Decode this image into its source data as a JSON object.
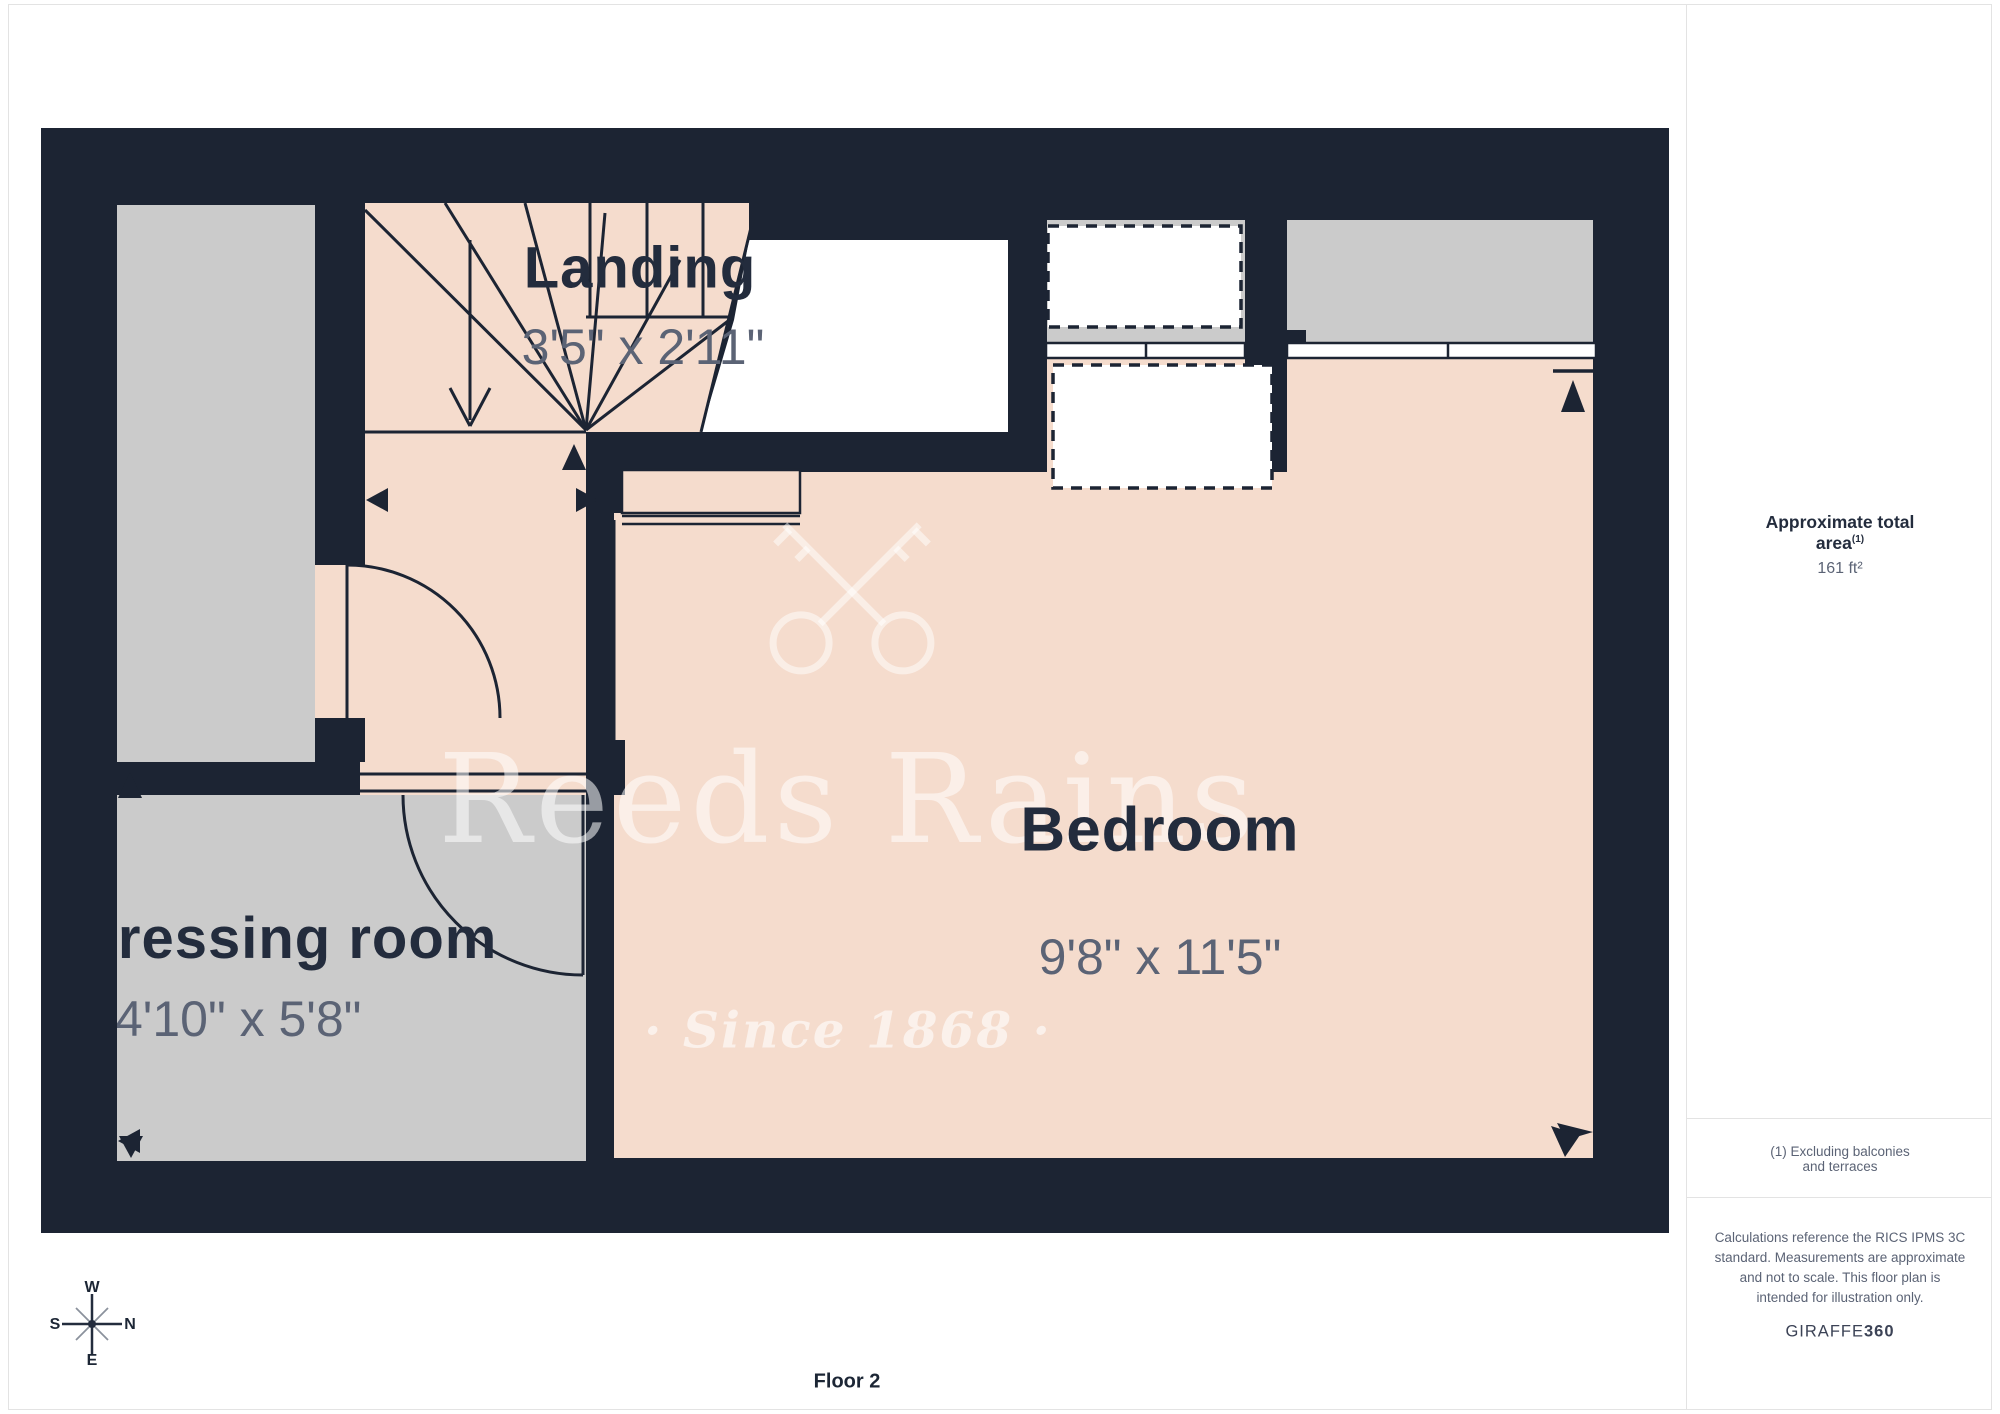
{
  "rooms": {
    "landing": {
      "name": "Landing",
      "dims": "3'5\" x 2'11\""
    },
    "bedroom": {
      "name": "Bedroom",
      "dims": "9'8\" x 11'5\""
    },
    "dressing": {
      "name": "Dressing room",
      "dims": "4'10\" x 5'8\""
    }
  },
  "watermark": {
    "line1": "Reeds Rains",
    "line2": "· Since 1868 ·"
  },
  "compass": {
    "w": "W",
    "e": "E",
    "s": "S",
    "n": "N"
  },
  "footer": {
    "floor_label": "Floor 2"
  },
  "sidebar": {
    "area_label": "Approximate total area",
    "area_note_ref": "(1)",
    "area_value": "161 ft²",
    "footnote": "(1) Excluding balconies and terraces",
    "disclaimer": "Calculations reference the RICS IPMS 3C standard. Measurements are approximate and not to scale. This floor plan is intended for illustration only.",
    "brand": "GIRAFFE",
    "brand_suffix": "360"
  },
  "colors": {
    "wall": "#1c2433",
    "floor": "#f5dccd",
    "secondary_floor": "#cbcbcb",
    "dim_text": "#5b6375",
    "name_text": "#232c3d",
    "border": "#e3e3e3"
  }
}
